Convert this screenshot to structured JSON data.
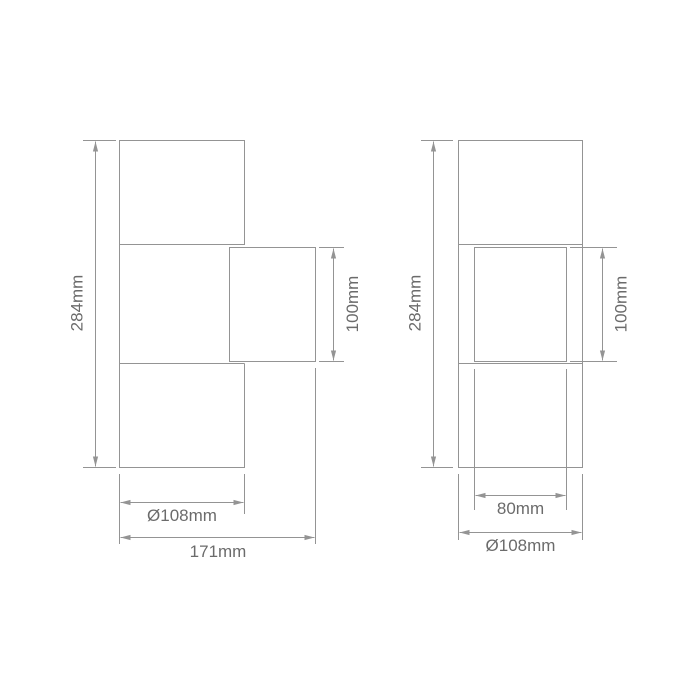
{
  "diagram": {
    "type": "technical-dimension-drawing",
    "subject": "wall-light-fixture-two-views",
    "background": "#ffffff",
    "line_color": "#949494",
    "text_color": "#6b6b6b",
    "side_view": {
      "name": "side-view",
      "overall_height": "284mm",
      "head_height": "100mm",
      "body_diameter": "Ø108mm",
      "overall_depth": "171mm"
    },
    "front_view": {
      "name": "front-view",
      "overall_height": "284mm",
      "head_height": "100mm",
      "inner_width": "80mm",
      "body_diameter": "Ø108mm"
    }
  }
}
